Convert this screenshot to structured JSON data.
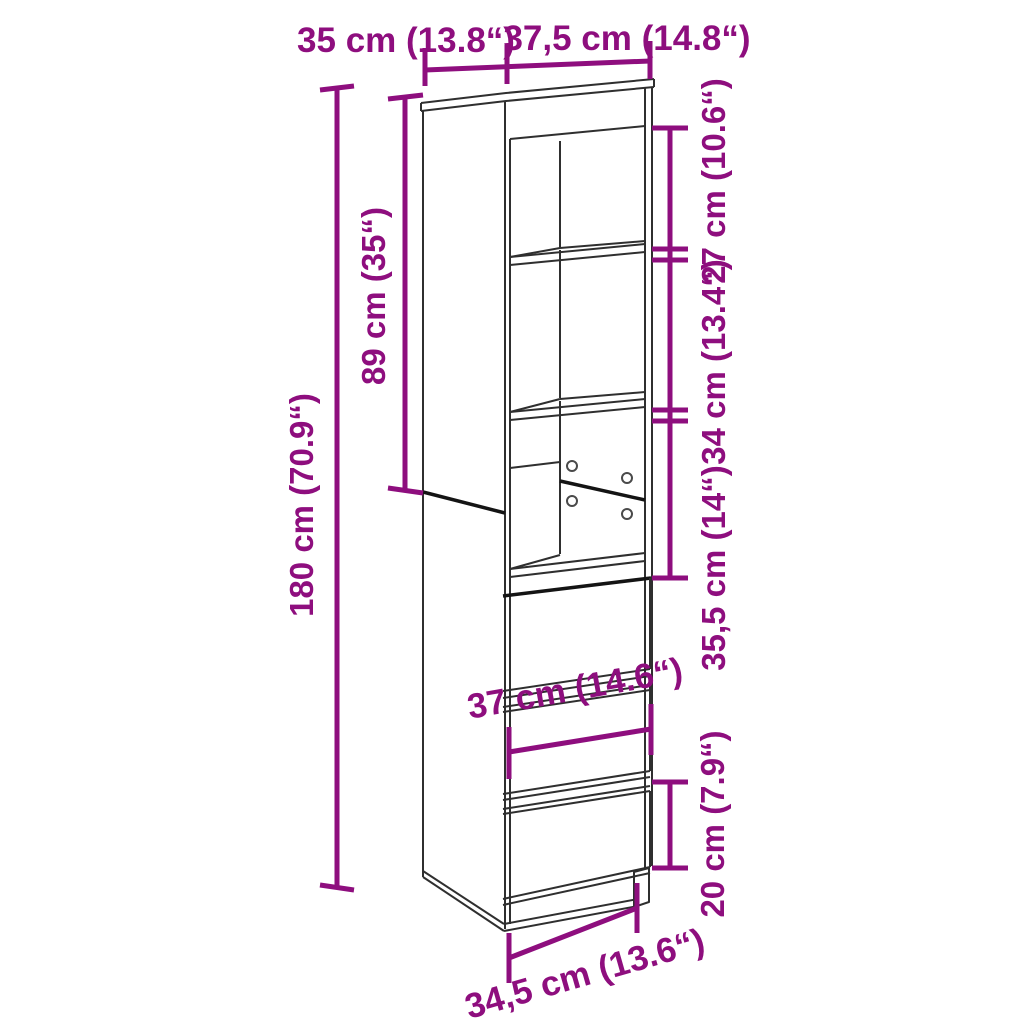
{
  "diagram": {
    "subject": "Tall highboard cabinet line drawing with three open shelf compartments and three drawers, annotated with measurements",
    "style": {
      "accent_color": "#8E0E7E",
      "line_color": "#2f2f2f",
      "background_color": "#ffffff"
    },
    "dims": {
      "depth": {
        "label": "35 cm (13.8“)",
        "cm": "35",
        "inches": "13.8"
      },
      "width": {
        "label": "37,5 cm (14.8“)",
        "cm": "37,5",
        "inches": "14.8"
      },
      "top_opening": {
        "label": "27 cm (10.6“)",
        "cm": "27",
        "inches": "10.6"
      },
      "middle_opening": {
        "label": "34 cm (13.4“)",
        "cm": "34",
        "inches": "13.4"
      },
      "lower_opening": {
        "label": "35,5 cm (14“)",
        "cm": "35,5",
        "inches": "14"
      },
      "upper_height": {
        "label": "89 cm (35“)",
        "cm": "89",
        "inches": "35"
      },
      "total_height": {
        "label": "180 cm (70.9“)",
        "cm": "180",
        "inches": "70.9"
      },
      "drawer_width": {
        "label": "37 cm (14.6“)",
        "cm": "37",
        "inches": "14.6"
      },
      "drawer_height": {
        "label": "20 cm (7.9“)",
        "cm": "20",
        "inches": "7.9"
      },
      "base_width": {
        "label": "34,5 cm (13.6“)",
        "cm": "34,5",
        "inches": "13.6"
      }
    }
  }
}
